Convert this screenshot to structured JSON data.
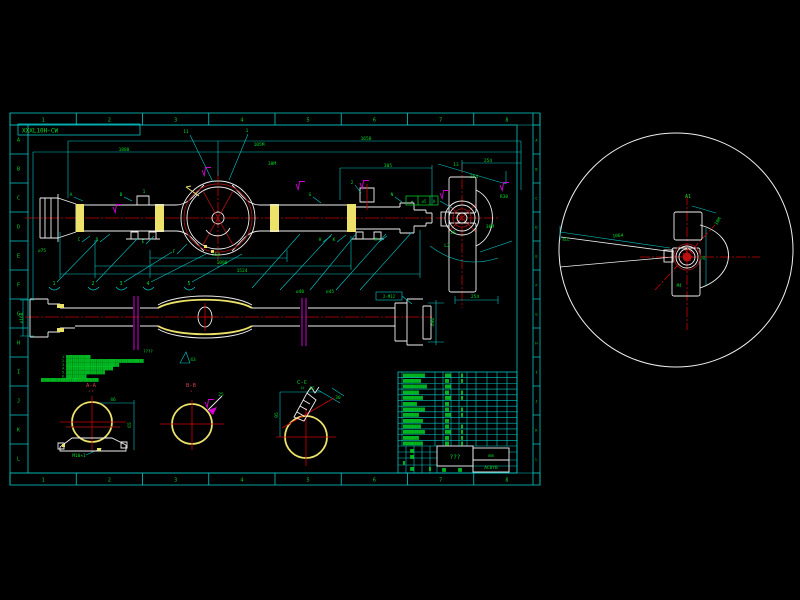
{
  "colors": {
    "background": "#000000",
    "frame_cyan": "#00c8c8",
    "annotation_green": "#00dc28",
    "centerline_red": "#cd0000",
    "dark_red": "#8f1010",
    "weld_yellow": "#ece26a",
    "geometry_white": "#f0f0f0",
    "break_magenta": "#d400d4"
  },
  "sheet": {
    "label": "XXXL10H-CW",
    "top_ruler": [
      "1",
      "2",
      "3",
      "4",
      "5",
      "6",
      "7",
      "8"
    ],
    "bottom_ruler": [
      "1",
      "2",
      "3",
      "4",
      "5",
      "6",
      "7",
      "8"
    ],
    "left_ruler": [
      "A",
      "B",
      "C",
      "D",
      "E",
      "F",
      "G",
      "H",
      "I",
      "J",
      "K",
      "L"
    ],
    "right_ruler": [
      "A",
      "B",
      "C",
      "D",
      "E",
      "F",
      "G",
      "H",
      "I",
      "J",
      "K",
      "L"
    ]
  },
  "title_block": {
    "title": "???",
    "units": "mm",
    "code": "AC8YB"
  },
  "bom": {
    "rows": [
      {
        "a": "▓▓▓▓▓▓▓▓▓▓▓",
        "b": "▓▓▓",
        "c": "▓"
      },
      {
        "a": "▓▓▓▓▓▓▓▓▓",
        "b": "▓▓",
        "c": "▓"
      },
      {
        "a": "▓▓▓▓▓▓▓▓▓▓▓▓",
        "b": "▓▓▓",
        "c": ""
      },
      {
        "a": "▓▓▓▓▓▓▓▓",
        "b": "▓▓",
        "c": "▓"
      },
      {
        "a": "▓▓▓▓▓▓▓▓▓▓",
        "b": "▓▓▓",
        "c": "▓"
      },
      {
        "a": "▓▓▓▓▓▓▓",
        "b": "▓▓",
        "c": ""
      },
      {
        "a": "▓▓▓▓▓▓▓▓▓▓▓",
        "b": "▓▓",
        "c": "▓"
      },
      {
        "a": "▓▓▓▓▓▓▓▓",
        "b": "▓▓▓",
        "c": "▓"
      },
      {
        "a": "▓▓▓▓▓▓▓▓▓▓",
        "b": "▓▓",
        "c": ""
      },
      {
        "a": "▓▓▓▓▓▓▓▓▓",
        "b": "▓▓",
        "c": "▓"
      },
      {
        "a": "▓▓▓▓▓▓▓▓▓▓▓",
        "b": "▓▓▓",
        "c": "▓"
      },
      {
        "a": "▓▓▓▓▓▓▓▓",
        "b": "▓▓",
        "c": "▓"
      },
      {
        "a": "▓▓▓▓▓▓▓▓▓▓",
        "b": "▓▓",
        "c": "▓"
      }
    ]
  },
  "notes": {
    "heading": "????",
    "lines": [
      "1.▓▓▓▓▓▓▓▓▓▓▓▓",
      "2.▓▓▓▓▓▓▓▓▓▓▓▓▓▓▓▓▓▓▓▓▓▓▓▓▓▓▓▓▓▓▓▓▓▓▓▓▓▓",
      "3.▓▓▓▓▓▓▓▓▓▓▓▓▓▓▓▓▓▓▓▓▓▓▓▓▓▓",
      "4.▓▓▓▓▓▓▓▓▓▓▓▓▓▓▓▓▓▓▓▓▓▓▓",
      "5.▓▓▓▓▓▓▓▓▓▓▓▓▓▓▓▓▓▓▓",
      "6.▓▓▓▓▓▓▓▓▓▓"
    ]
  },
  "balloons": {
    "items": [
      {
        "n": "1",
        "x": 54,
        "y": 285
      },
      {
        "n": "2",
        "x": 93,
        "y": 285
      },
      {
        "n": "3",
        "x": 121,
        "y": 285
      },
      {
        "n": "4",
        "x": 148,
        "y": 285
      },
      {
        "n": "5",
        "x": 189,
        "y": 285
      }
    ]
  },
  "annotations": [
    {
      "x": 186,
      "y": 133,
      "t": "11"
    },
    {
      "x": 247,
      "y": 132,
      "t": "1"
    },
    {
      "x": 366,
      "y": 140,
      "t": "1658"
    },
    {
      "x": 124,
      "y": 151,
      "t": "1880"
    },
    {
      "x": 259,
      "y": 146,
      "t": "105M"
    },
    {
      "x": 272,
      "y": 165,
      "t": "30M"
    },
    {
      "x": 488,
      "y": 162,
      "t": "254"
    },
    {
      "x": 388,
      "y": 167,
      "t": "305"
    },
    {
      "x": 71,
      "y": 196,
      "t": "A"
    },
    {
      "x": 121,
      "y": 196,
      "t": "B"
    },
    {
      "x": 144,
      "y": 193,
      "t": "1"
    },
    {
      "x": 79,
      "y": 241,
      "t": "C"
    },
    {
      "x": 97,
      "y": 241,
      "t": "D"
    },
    {
      "x": 143,
      "y": 243,
      "t": "E"
    },
    {
      "x": 174,
      "y": 253,
      "t": "F"
    },
    {
      "x": 310,
      "y": 196,
      "t": "G"
    },
    {
      "x": 320,
      "y": 241,
      "t": "H"
    },
    {
      "x": 334,
      "y": 241,
      "t": "K"
    },
    {
      "x": 376,
      "y": 241,
      "t": "M"
    },
    {
      "x": 392,
      "y": 196,
      "t": "N"
    },
    {
      "x": 352,
      "y": 184,
      "t": "2"
    },
    {
      "x": 216,
      "y": 256,
      "t": "254"
    },
    {
      "x": 222,
      "y": 264,
      "t": "1090"
    },
    {
      "x": 242,
      "y": 272,
      "t": "1524"
    },
    {
      "x": 300,
      "y": 293,
      "t": "⌀40"
    },
    {
      "x": 330,
      "y": 293,
      "t": "⌀45"
    },
    {
      "x": 42,
      "y": 252,
      "t": "⌀75"
    },
    {
      "x": 447,
      "y": 247,
      "t": "L2"
    },
    {
      "x": 490,
      "y": 228,
      "t": "30M"
    },
    {
      "x": 453,
      "y": 234,
      "t": "25"
    },
    {
      "x": 456,
      "y": 166,
      "t": "13"
    },
    {
      "x": 474,
      "y": 178,
      "t": "254"
    },
    {
      "x": 504,
      "y": 198,
      "t": "R30"
    },
    {
      "x": 475,
      "y": 298,
      "t": "254"
    },
    {
      "x": 412,
      "y": 203,
      "t": "⌖",
      "s": 4
    },
    {
      "x": 424,
      "y": 203,
      "t": "⌀5",
      "s": 4
    },
    {
      "x": 434,
      "y": 203,
      "t": "A",
      "s": 4
    },
    {
      "x": 23,
      "y": 318,
      "t": "⌀168",
      "r": -90
    },
    {
      "x": 389,
      "y": 298,
      "t": "2-M12",
      "s": 4
    },
    {
      "x": 434,
      "y": 322,
      "t": "⌀90",
      "r": -90
    },
    {
      "x": 193,
      "y": 361,
      "t": "43"
    },
    {
      "x": 91,
      "y": 387,
      "t": "A-A",
      "c": "r",
      "s": 5.5
    },
    {
      "x": 91,
      "y": 392,
      "t": "1 1",
      "c": "r",
      "s": 3
    },
    {
      "x": 191,
      "y": 387,
      "t": "B-B",
      "c": "r",
      "s": 5.5
    },
    {
      "x": 191,
      "y": 392,
      "t": "1",
      "c": "r",
      "s": 3
    },
    {
      "x": 302,
      "y": 384,
      "t": "C-C",
      "s": 5.5
    },
    {
      "x": 302,
      "y": 389,
      "t": "14",
      "s": 3.2
    },
    {
      "x": 131,
      "y": 425,
      "t": "65",
      "r": -90
    },
    {
      "x": 113,
      "y": 401,
      "t": "46"
    },
    {
      "x": 79,
      "y": 457,
      "t": "M10×1"
    },
    {
      "x": 278,
      "y": 415,
      "t": "95",
      "r": -90
    },
    {
      "x": 312,
      "y": 390,
      "t": "15"
    },
    {
      "x": 338,
      "y": 399,
      "t": "30"
    },
    {
      "x": 221,
      "y": 396,
      "t": "25"
    },
    {
      "x": 688,
      "y": 198,
      "t": "A1",
      "s": 5
    },
    {
      "x": 719,
      "y": 222,
      "t": "10M",
      "r": -58
    },
    {
      "x": 566,
      "y": 241,
      "t": "4CL",
      "s": 4
    },
    {
      "x": 618,
      "y": 237,
      "t": "1064",
      "r": -5
    },
    {
      "x": 679,
      "y": 287,
      "t": "M4",
      "s": 4
    },
    {
      "x": 705,
      "y": 258,
      "t": "30",
      "r": -90,
      "s": 4
    },
    {
      "x": 41,
      "y": 381,
      "t": "▓▓▓▓▓▓▓▓▓▓▓▓▓▓▓▓▓▓▓▓▓▓▓▓▓▓▓▓▓▓",
      "s": 3.2,
      "an": "s"
    },
    {
      "x": 412,
      "y": 452,
      "t": "▓▓",
      "s": 3.2
    },
    {
      "x": 412,
      "y": 458,
      "t": "▓▓",
      "s": 3.2
    },
    {
      "x": 404,
      "y": 464,
      "t": "▓",
      "s": 3.2
    },
    {
      "x": 412,
      "y": 470,
      "t": "▓▓",
      "s": 3.2
    },
    {
      "x": 430,
      "y": 470,
      "t": "▓",
      "s": 3.2
    },
    {
      "x": 444,
      "y": 471,
      "t": "▓▓",
      "s": 3.2
    },
    {
      "x": 460,
      "y": 471,
      "t": "▓▓",
      "s": 3.2
    }
  ],
  "flags": [
    {
      "x": 202,
      "y": 170
    },
    {
      "x": 296,
      "y": 184
    },
    {
      "x": 113,
      "y": 207
    },
    {
      "x": 440,
      "y": 193
    },
    {
      "x": 500,
      "y": 185
    },
    {
      "x": 205,
      "y": 402
    },
    {
      "x": 360,
      "y": 183
    }
  ]
}
